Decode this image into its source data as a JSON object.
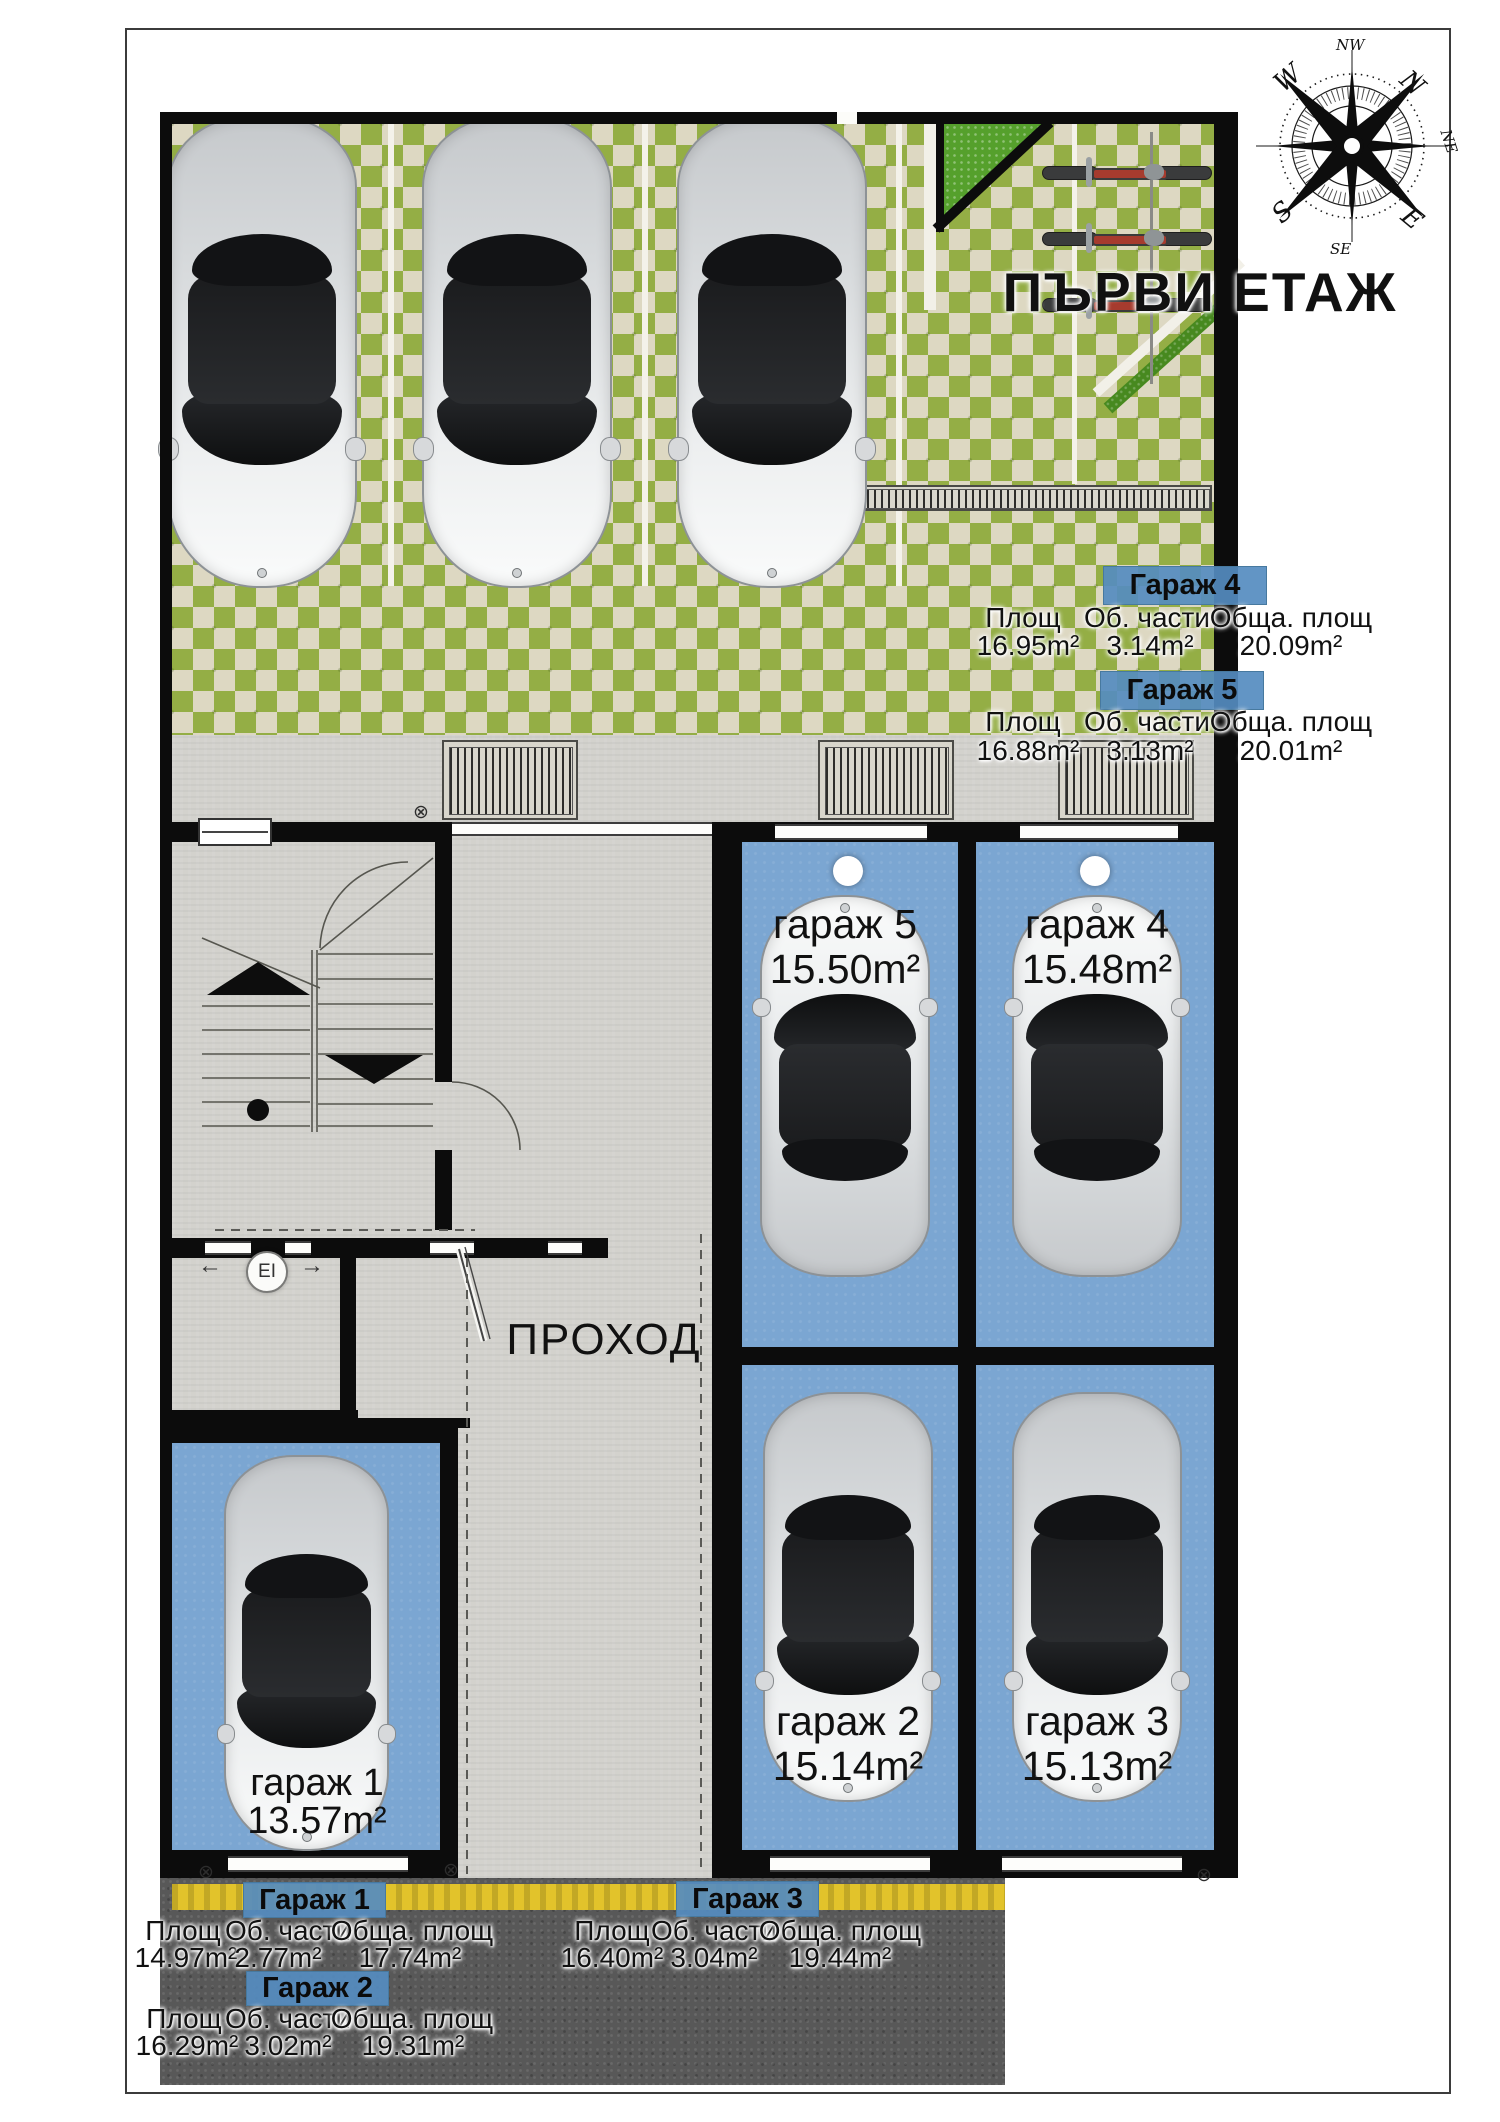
{
  "title": "ПЪРВИ ЕТАЖ",
  "compass": {
    "n": "N",
    "ne": "NE",
    "e": "E",
    "se": "SE",
    "s": "S",
    "w": "W",
    "nw": "NW"
  },
  "info_tables": {
    "garage4": {
      "title": "Гараж 4",
      "col1": "Площ",
      "col2": "Об. части",
      "col3": "Обща. площ",
      "val1": "16.95m²",
      "val2": "3.14m²",
      "val3": "20.09m²"
    },
    "garage5": {
      "title": "Гараж 5",
      "col1": "Площ",
      "col2": "Об. части",
      "col3": "Обща. площ",
      "val1": "16.88m²",
      "val2": "3.13m²",
      "val3": "20.01m²"
    },
    "garage1": {
      "title": "Гараж 1",
      "col1": "Площ",
      "col2": "Об. части",
      "col3": "Обща. площ",
      "val1": "14.97m²",
      "val2": "2.77m²",
      "val3": "17.74m²"
    },
    "garage3": {
      "title": "Гараж 3",
      "col1": "Площ",
      "col2": "Об. части",
      "col3": "Обща. площ",
      "val1": "16.40m²",
      "val2": "3.04m²",
      "val3": "19.44m²"
    },
    "garage2": {
      "title": "Гараж 2",
      "col1": "Площ",
      "col2": "Об. части",
      "col3": "Обща. площ",
      "val1": "16.29m²",
      "val2": "3.02m²",
      "val3": "19.31m²"
    }
  },
  "floor_labels": {
    "garage5": {
      "name": "гараж 5",
      "area": "15.50m²"
    },
    "garage4": {
      "name": "гараж 4",
      "area": "15.48m²"
    },
    "garage2": {
      "name": "гараж 2",
      "area": "15.14m²"
    },
    "garage3": {
      "name": "гараж 3",
      "area": "15.13m²"
    },
    "garage1": {
      "name": "гараж 1",
      "area": "13.57m²"
    },
    "corridor": "ПРОХОД",
    "elevator": "EI"
  },
  "icons": {
    "survey_marker": "⊗",
    "arrow_left": "←",
    "arrow_right": "→"
  },
  "colors": {
    "floor_blue": "#7ba6d2",
    "header_blue": "#558cc0",
    "grass_green": "#94ae45",
    "lawn_green": "#55a02c",
    "asphalt_gray": "#585858",
    "road_line_yellow": "#e2c32b"
  }
}
